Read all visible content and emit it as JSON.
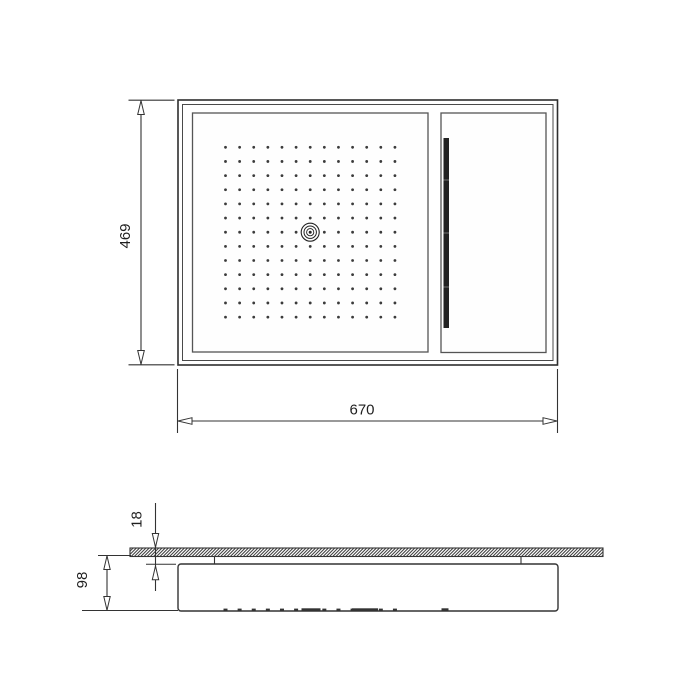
{
  "drawing": {
    "name": "ceiling-shower-head-dimension-drawing",
    "background": "#ffffff",
    "line_color": "#333333",
    "panel_line_color": "#555555",
    "text_color": "#1f1f1f",
    "dimensions": {
      "overall_height": "469",
      "overall_width": "670",
      "plate_thickness": "18",
      "body_depth": "98"
    },
    "top_view": {
      "nozzle_grid": {
        "cols": 13,
        "rows": 13,
        "x0": 225.5,
        "y0": 147.3,
        "dx": 14.12,
        "dy": 14.15,
        "dot_radius": 1.4,
        "dot_color": "#3b3b3b",
        "skip_col": 6,
        "skip_row": 6
      },
      "center_nozzle": {
        "cx": 310.2,
        "cy": 232.2,
        "ring_radii": [
          9,
          6.2,
          3.6
        ],
        "dot_radius": 1.5,
        "color": "#222222"
      },
      "waterfall_slot": {
        "x": 443.5,
        "y": 138,
        "width": 5.5,
        "height": 190,
        "color": "#222222",
        "notch_ys": [
          180,
          233,
          287
        ],
        "notch_color": "#888888"
      }
    },
    "side_view": {
      "plate": {
        "x": 130,
        "y": 548,
        "width": 473,
        "height": 8.5,
        "hatch_step": 3.2,
        "hatch_color": "#3d3d3d"
      },
      "body": {
        "x": 178,
        "y": 564,
        "width": 380,
        "height": 47
      },
      "connector_xs": [
        214.5,
        521
      ],
      "bottom_dashes": {
        "y": 608.6,
        "height": 2.2,
        "width": 4,
        "extra": [
          {
            "x": 301.5,
            "w": 19
          },
          {
            "x": 352,
            "w": 26
          },
          {
            "x": 441.5,
            "w": 7
          }
        ]
      }
    }
  }
}
